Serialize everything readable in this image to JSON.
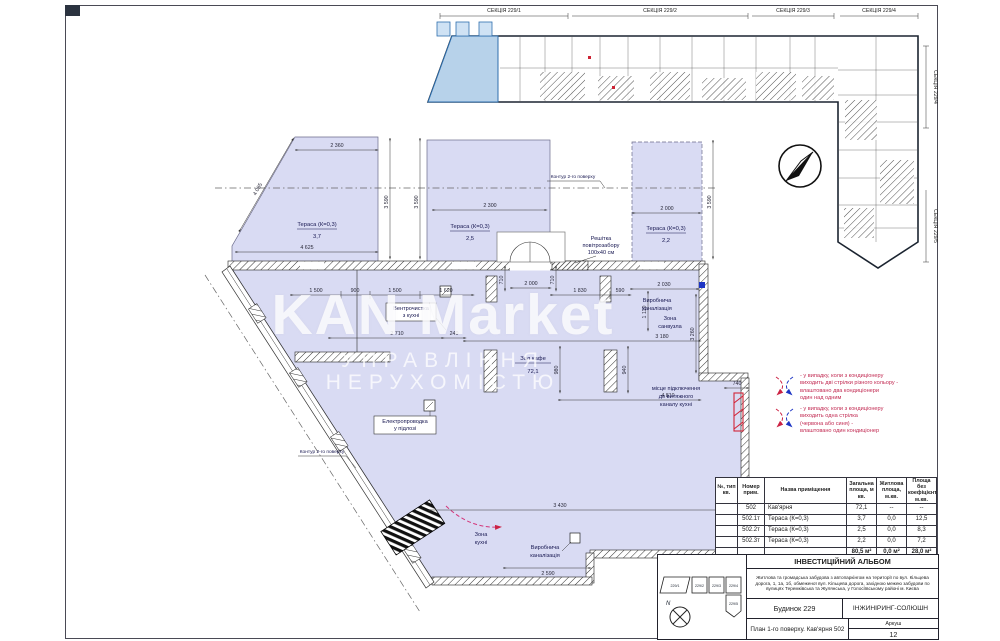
{
  "keyplan": {
    "sections_top": [
      "СЕКЦІЯ 229/1",
      "СЕКЦІЯ 229/2",
      "СЕКЦІЯ 229/3",
      "СЕКЦІЯ 229/4"
    ],
    "sections_right": [
      "СЕКЦІЯ 229/4",
      "СЕКЦІЯ 229/5"
    ],
    "highlight_color": "#b7d2ea"
  },
  "plan": {
    "fill_color": "#d9dbf3",
    "terraces": [
      {
        "name": "Тераса (К=0,3)",
        "area": "3,7"
      },
      {
        "name": "Тераса (К=0,3)",
        "area": "2,5"
      },
      {
        "name": "Тераса (К=0,3)",
        "area": "2,2"
      }
    ],
    "hall": {
      "name": "Зал кафе",
      "area": "72,1"
    },
    "labels": {
      "prod_sewer_a": [
        "Виробнича",
        "каналізація"
      ],
      "prod_sewer_b": [
        "Виробнича",
        "каналізація"
      ],
      "wc_zone": [
        "Зона",
        "санвузла"
      ],
      "kitchen_zone": [
        "Зона",
        "кухні"
      ],
      "duct": [
        "місце підключення",
        "до витяжного",
        "каналу кухні"
      ],
      "grille": [
        "Решітка",
        "повітрозабору",
        "100х40 см"
      ],
      "vent_box": [
        "Вентрочистка",
        "з кухні"
      ],
      "electro_box": [
        "Електропроводка",
        "у підлозі"
      ],
      "contour_top": "Контур 2-го поверху",
      "contour_left": "Контур 2-го поверху"
    },
    "dims": {
      "t1_top": "2 360",
      "t1_bottom": "4 625",
      "t1_slant": "4 085",
      "g1": "3 590",
      "g2": "3 590",
      "g3": "3 590",
      "t2_top": "2 300",
      "t3_top": "2 000",
      "c1": "1 500",
      "c2": "900",
      "c3": "1 500",
      "c4": "1 620",
      "door": "2 000",
      "c5": "1 830",
      "c6": "590",
      "c7": "2 030",
      "v1": "710",
      "v2": "710",
      "v3": "1 110",
      "v4": "980",
      "v5": "940",
      "v6": "3 260",
      "m1": "2 710",
      "m2": "240",
      "m3": "3 180",
      "m4": "4 810",
      "b1": "3 430",
      "b2": "2 590",
      "b3": "740"
    },
    "accent_red": "#cc2244",
    "accent_blue": "#1d35c4"
  },
  "legend": {
    "item1": [
      "- у випадку, коли з кондиціонеру",
      "виходить дві стрілки різного кольору -",
      "влаштовано два кондиціонери",
      "один над одним"
    ],
    "item2": [
      "- у випадку, коли з кондиціонеру",
      "виходить одна стрілка",
      "(червона або синя) -",
      "влаштовано один кондиціонер"
    ]
  },
  "watermark": {
    "line1": "KAN Market",
    "line2": "УПРАВЛІННЯ НЕРУХОМІСТЮ"
  },
  "table": {
    "headers": [
      "№, тип кв.",
      "Номер прим.",
      "Назва приміщення",
      "Загальна площа, м кв.",
      "Житлова площа, м.кв.",
      "Площа без коефіцієнту, м.кв."
    ],
    "rows": [
      {
        "id": "502",
        "name": "Кав'ярня",
        "total": "72,1",
        "living": "--",
        "nocoef": "--"
      },
      {
        "id": "502.1т",
        "name": "Тераса (К=0,3)",
        "total": "3,7",
        "living": "0,0",
        "nocoef": "12,5"
      },
      {
        "id": "502.2т",
        "name": "Тераса (К=0,3)",
        "total": "2,5",
        "living": "0,0",
        "nocoef": "8,3"
      },
      {
        "id": "502.3т",
        "name": "Тераса (К=0,3)",
        "total": "2,2",
        "living": "0,0",
        "nocoef": "7,2"
      }
    ],
    "totals": {
      "total": "80,5 м²",
      "living": "0,0 м²",
      "nocoef": "28,0 м²"
    }
  },
  "titleblock": {
    "album_title": "ІНВЕСТИЦІЙНИЙ АЛЬБОМ",
    "description": "Житлова та громадська забудова з автопаркінгом на території по вул. Кільцева дорога, 1, 1а, 1б, обмеженої вул. Кільцева дорога, західною межею забудови по вулицях Теремківська та Жулянська, у Голосіївському районі м. Києва",
    "building": "Будинок 229",
    "company": "ІНЖИНІРИНГ-СОЛЮШН",
    "sheet_title": "План 1-го поверху. Кав'ярня 502",
    "sheet_label": "Аркуш",
    "sheet_number": "12",
    "miniplan": [
      "229/1",
      "229/2",
      "229/3",
      "229/4",
      "229/5"
    ],
    "north": "N"
  }
}
